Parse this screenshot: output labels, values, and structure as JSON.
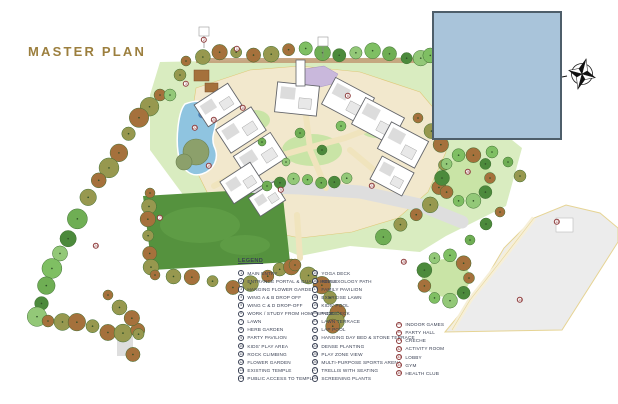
{
  "page": {
    "title": "MASTER PLAN"
  },
  "theme": {
    "title_color": "#9c7f3e",
    "legend_text": "#3a4154",
    "circle_navy": "#3a4154",
    "circle_maroon": "#8d3a3a"
  },
  "legend": {
    "heading": "LEGEND",
    "columns": [
      {
        "style": "navy",
        "items": [
          {
            "n": "1",
            "label": "MAIN ENTRY"
          },
          {
            "n": "2",
            "label": "ENTRANCE PORTAL & GUARD HOUSE"
          },
          {
            "n": "3",
            "label": "HANGING FLOWER GARDEN"
          },
          {
            "n": "4",
            "label": "WING A & B DROP OFF"
          },
          {
            "n": "5",
            "label": "WING C & D DROP-OFF"
          },
          {
            "n": "6",
            "label": "WORK / STUDY FROM HOME SPACES"
          },
          {
            "n": "7",
            "label": "LAWN"
          },
          {
            "n": "8",
            "label": "HERB GARDEN"
          },
          {
            "n": "9",
            "label": "PARTY PAVILION"
          },
          {
            "n": "10",
            "label": "KIDS' PLAY AREA"
          },
          {
            "n": "11",
            "label": "ROCK CLIMBING"
          },
          {
            "n": "12",
            "label": "FLOWER GARDEN"
          },
          {
            "n": "13",
            "label": "EXISTING TEMPLE"
          },
          {
            "n": "14",
            "label": "PUBLIC ACCESS TO TEMPLE"
          }
        ]
      },
      {
        "style": "navy",
        "items": [
          {
            "n": "15",
            "label": "YOGA DECK"
          },
          {
            "n": "16",
            "label": "REFLEXOLOGY PATH"
          },
          {
            "n": "17",
            "label": "FAMILY PAVILION"
          },
          {
            "n": "18",
            "label": "EXERCISE LAWN"
          },
          {
            "n": "19",
            "label": "KIDS' POOL"
          },
          {
            "n": "20",
            "label": "POOL DECK"
          },
          {
            "n": "21",
            "label": "LAWN TERRACE"
          },
          {
            "n": "22",
            "label": "LAP POOL"
          },
          {
            "n": "23",
            "label": "HANGING DAY BED & STONE TERRACE"
          },
          {
            "n": "24",
            "label": "DENSE PLANTING"
          },
          {
            "n": "25",
            "label": "PLAY ZONE VIEW"
          },
          {
            "n": "26",
            "label": "MULTI-PURPOSE SPORTS ARENA"
          },
          {
            "n": "27",
            "label": "TRELLIS WITH SEATING"
          },
          {
            "n": "28",
            "label": "SCREENING PLANTS"
          }
        ]
      },
      {
        "style": "maroon",
        "items": [
          {
            "n": "29",
            "label": "INDOOR GAMES"
          },
          {
            "n": "30",
            "label": "PARTY HALL"
          },
          {
            "n": "31",
            "label": "CRECHE"
          },
          {
            "n": "32",
            "label": "ACTIVITY ROOM"
          },
          {
            "n": "33",
            "label": "LOBBY"
          },
          {
            "n": "34",
            "label": "GYM"
          },
          {
            "n": "35",
            "label": "HEALTH CLUB"
          }
        ]
      }
    ]
  },
  "map": {
    "colors": {
      "site_lawn": "#d9ecc0",
      "lawn_patch": "#c9e4a6",
      "dark_lawn": "#55923e",
      "pool": "#8fc4e0",
      "pool_deep": "#4a7fb5",
      "path": "#f0e4bd",
      "path_edge": "#dfc878",
      "road": "#dedede",
      "plaza": "#ececec",
      "plaza_edge": "#e6d494",
      "tree_green": "#6fae54",
      "tree_dark": "#4c8a3c",
      "tree_light": "#93c878",
      "tree_olive": "#97984f",
      "tree_brown": "#a5713c",
      "building_fill": "#ffffff",
      "building_stroke": "#63656a",
      "mask_fill": "#a9c4da",
      "mask_stroke": "#4e5e6a",
      "marker": "#8d3a3a"
    },
    "markers": [
      {
        "n": "2",
        "x": 204,
        "y": 40
      },
      {
        "n": "1",
        "x": 237,
        "y": 49
      },
      {
        "n": "3",
        "x": 186,
        "y": 84
      },
      {
        "n": "10",
        "x": 243,
        "y": 108
      },
      {
        "n": "22",
        "x": 195,
        "y": 128
      },
      {
        "n": "20",
        "x": 214,
        "y": 120
      },
      {
        "n": "19",
        "x": 209,
        "y": 166
      },
      {
        "n": "6",
        "x": 348,
        "y": 96
      },
      {
        "n": "9",
        "x": 281,
        "y": 190
      },
      {
        "n": "7",
        "x": 160,
        "y": 218
      },
      {
        "n": "24",
        "x": 96,
        "y": 246
      },
      {
        "n": "23",
        "x": 372,
        "y": 186
      },
      {
        "n": "26",
        "x": 468,
        "y": 172
      },
      {
        "n": "28",
        "x": 404,
        "y": 262
      },
      {
        "n": "13",
        "x": 557,
        "y": 222
      },
      {
        "n": "14",
        "x": 520,
        "y": 300
      }
    ]
  }
}
